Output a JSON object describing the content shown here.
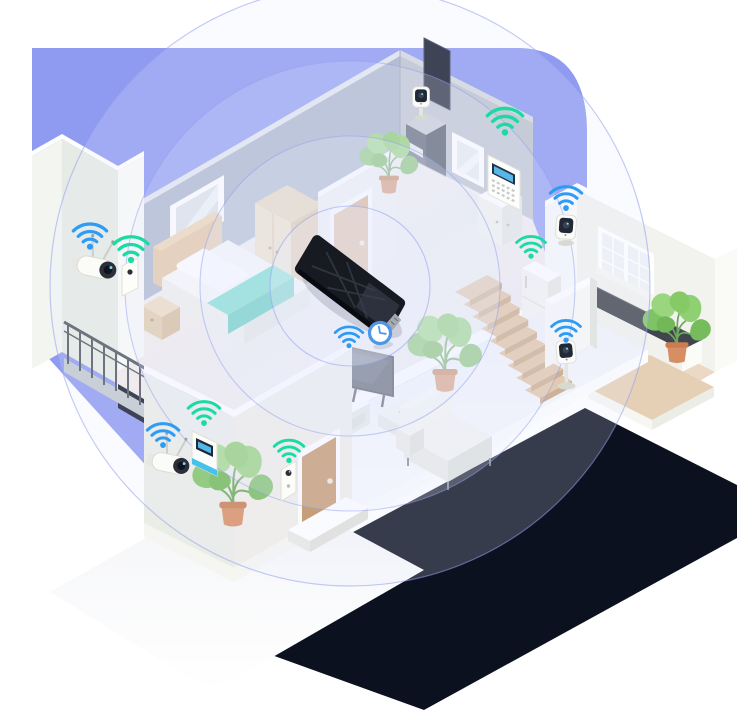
{
  "meta": {
    "description": "Isometric illustration of a two-story smart home with a central Wi-Fi router providing whole-home wireless coverage to connected smart devices",
    "scene": "smart-home-wifi-coverage"
  },
  "colors": {
    "page_bg": "#FFFFFF",
    "background_circle": "#8F9BF0",
    "coverage_ring_fill": "rgba(232,237,255,0.20)",
    "coverage_ring_stroke": "rgba(147,161,238,0.60)",
    "wifi_blue": "#2E9BF5",
    "wifi_teal": "#1BDBA2",
    "router_body": "#171A21",
    "clock_accent": "#4E97E8",
    "blanket_teal": "#5ED8C2",
    "plant_green": "#82C565",
    "wood_door": "#C08B59",
    "base_shadow": "#0C1120"
  },
  "coverage": {
    "ring_count": 4,
    "radii": [
      80,
      150,
      225,
      300
    ]
  },
  "router": {
    "label": "wifi-router",
    "location": "upper-hall-floor"
  },
  "devices": [
    {
      "label": "outdoor-camera-balcony",
      "signal": "blue"
    },
    {
      "label": "motion-sensor-bedroom-wall",
      "signal": "teal"
    },
    {
      "label": "shelf-camera-upper-hall",
      "signal": "none"
    },
    {
      "label": "smart-control-panel",
      "signal": "teal"
    },
    {
      "label": "corner-camera-kitchen",
      "signal": "blue"
    },
    {
      "label": "smart-fridge",
      "signal": "teal"
    },
    {
      "label": "stair-camera",
      "signal": "blue"
    },
    {
      "label": "smart-tv",
      "signal": "blue"
    },
    {
      "label": "entry-control-panel",
      "signal": "teal"
    },
    {
      "label": "outdoor-camera-entrance",
      "signal": "blue"
    },
    {
      "label": "smart-doorbell",
      "signal": "teal"
    },
    {
      "label": "wall-clock",
      "signal": "none"
    }
  ],
  "rooms": [
    {
      "label": "bedroom"
    },
    {
      "label": "upper-hall"
    },
    {
      "label": "balcony"
    },
    {
      "label": "kitchen"
    },
    {
      "label": "living-room"
    },
    {
      "label": "entrance"
    },
    {
      "label": "stairs"
    }
  ],
  "plants": {
    "count": 4
  }
}
